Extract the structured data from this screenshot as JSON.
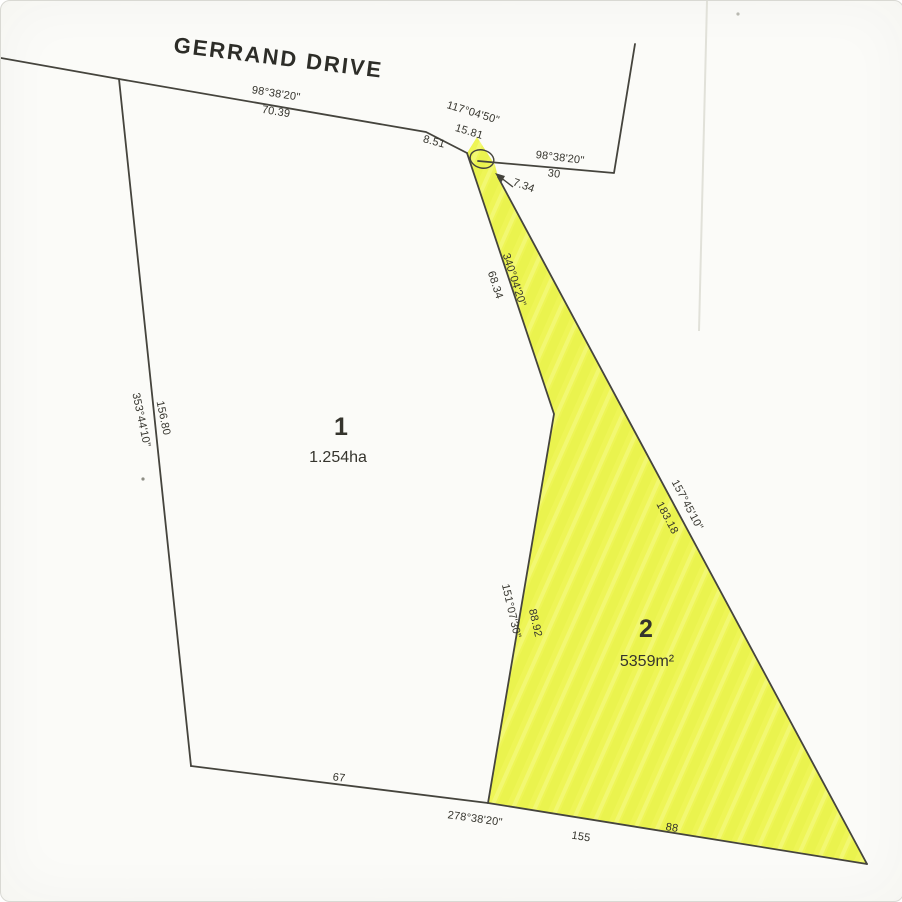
{
  "street": {
    "name": "GERRAND DRIVE"
  },
  "lots": {
    "lot1": {
      "number": "1",
      "area": "1.254ha"
    },
    "lot2": {
      "number": "2",
      "area": "5359m²"
    }
  },
  "boundaries": {
    "road_north": {
      "bearing": "98°38'20\"",
      "distance": "70.39"
    },
    "road_splay": {
      "bearing": "117°04'50\"",
      "distance": "15.81"
    },
    "road_jog": {
      "distance": "8.51"
    },
    "road_east": {
      "bearing": "98°38'20\"",
      "distance": "30"
    },
    "strip_neck": {
      "distance": "7.34"
    },
    "strip_west": {
      "bearing": "340°04'20\"",
      "distance": "68.34"
    },
    "lot2_east": {
      "bearing": "157°45'10\"",
      "distance": "183.18"
    },
    "divider": {
      "bearing": "151°07'30\"",
      "distance": "88.92"
    },
    "west": {
      "bearing": "353°44'10\"",
      "distance": "156.80"
    },
    "lot1_south": {
      "bearing": "278°38'20\"",
      "distance": "67"
    },
    "lot2_south": {
      "distance": "155",
      "offset": "88"
    }
  },
  "colors": {
    "highlight": "#eef556",
    "line": "#45443d",
    "text": "#35342d",
    "paper": "#fbfbf8"
  }
}
